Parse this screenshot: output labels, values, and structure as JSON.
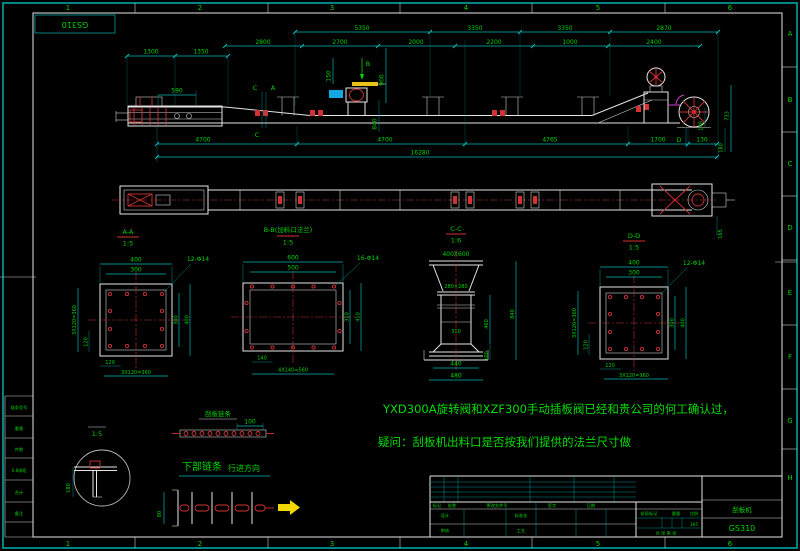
{
  "sheet": {
    "code": "GS310",
    "zones_top": [
      "1",
      "2",
      "3",
      "4",
      "5",
      "6"
    ],
    "zones_bottom": [
      "1",
      "2",
      "3",
      "4",
      "5",
      "6"
    ],
    "zones_right": [
      "A",
      "B",
      "C",
      "D",
      "E",
      "F",
      "G",
      "H"
    ]
  },
  "colors": {
    "background": "#000000",
    "frame": "#00a6a6",
    "dim_text": "#00d400",
    "dim_line": "#00b4b4",
    "geometry": "#e6e6e6",
    "detail_red": "#d23232",
    "valve_blue": "#11a9e0",
    "handle_yellow": "#e6c21a",
    "arrow_yellow": "#f2d800"
  },
  "elevation": {
    "dims_row1": [
      "5350",
      "3350",
      "3350",
      "2870"
    ],
    "dims_row2": [
      "2800",
      "2700",
      "2000",
      "2200",
      "1000",
      "2400"
    ],
    "dims_row3": [
      "1300",
      "1350"
    ],
    "dim_590": "590",
    "dim_150": "150",
    "dim_900": "900",
    "dim_840": "840",
    "mark_b": "B",
    "mark_c1": "C",
    "mark_a": "A",
    "mark_c2": "C",
    "mark_d": "D",
    "dim_148": "148",
    "dim_733": "733",
    "dim_180": "180",
    "dims_bottom": [
      "4700",
      "4700",
      "4765",
      "1700",
      "130"
    ],
    "dim_total": "16280"
  },
  "plan": {
    "dim_165": "165"
  },
  "section_aa": {
    "title": "A-A",
    "scale": "1:5",
    "dim_top_outer": "400",
    "dim_top_inner": "300",
    "holes": "12-Φ14",
    "dim_right_inner": "300",
    "dim_right_outer": "400",
    "dim_left_pitch": "3X120=360",
    "dim_left_off": "120",
    "dim_bottom_off": "120",
    "dim_bottom_pitch": "3X120=360"
  },
  "section_bb": {
    "title": "B-B(加料口法兰)",
    "scale": "1:5",
    "dim_top_outer": "600",
    "dim_top_inner": "500",
    "holes": "16-Φ14",
    "dim_right_inner": "310",
    "dim_right_outer": "410",
    "dim_bottom_off": "140",
    "dim_bottom_pitch": "4X140=560"
  },
  "section_cc": {
    "title": "C-C",
    "scale": "1:6",
    "dim_top": "400X600",
    "dim_mid": "280×280",
    "dim_body": "310",
    "dim_right_body": "460",
    "dim_right_bottom": "100",
    "dim_right_total": "840",
    "dim_bottom_1": "440",
    "dim_bottom_2": "480"
  },
  "section_dd": {
    "title": "D-D",
    "scale": "1:5",
    "dim_top_outer": "400",
    "dim_top_inner": "300",
    "holes": "12-Φ14",
    "dim_right_inner": "300",
    "dim_right_outer": "400",
    "dim_left_pitch": "3X120=360",
    "dim_left_off": "120",
    "dim_bottom_off": "120",
    "dim_bottom_pitch": "3X120=360"
  },
  "notes": {
    "line1": "YXD300A旋转阀和XZF300手动插板阀已经和贵公司的何工确认过，",
    "line2": "疑问：刮板机出料口是否按我们提供的法兰尺寸做"
  },
  "chain": {
    "title": "刮板链条",
    "dim_100": "100",
    "lower_label": "下部链条",
    "dir_label": "行进方向",
    "dim_80": "80",
    "detail_scale": "1:5",
    "dim_180": "180"
  },
  "parts_table": {
    "rows": [
      "链条型号",
      "重量",
      "件数",
      "0.8排距",
      "合计",
      "备注"
    ]
  },
  "title_block": {
    "headers": [
      "标记",
      "处数",
      "更改文件号",
      "签字",
      "日期"
    ],
    "design": "设计",
    "check": "审核",
    "std": "标准化",
    "craft": "工艺",
    "stage": "阶段标记",
    "weight": "重量",
    "scale": "比例",
    "weight_value": "365",
    "sheets": "共 张 第 张",
    "product": "刮板机",
    "code": "GS310"
  }
}
